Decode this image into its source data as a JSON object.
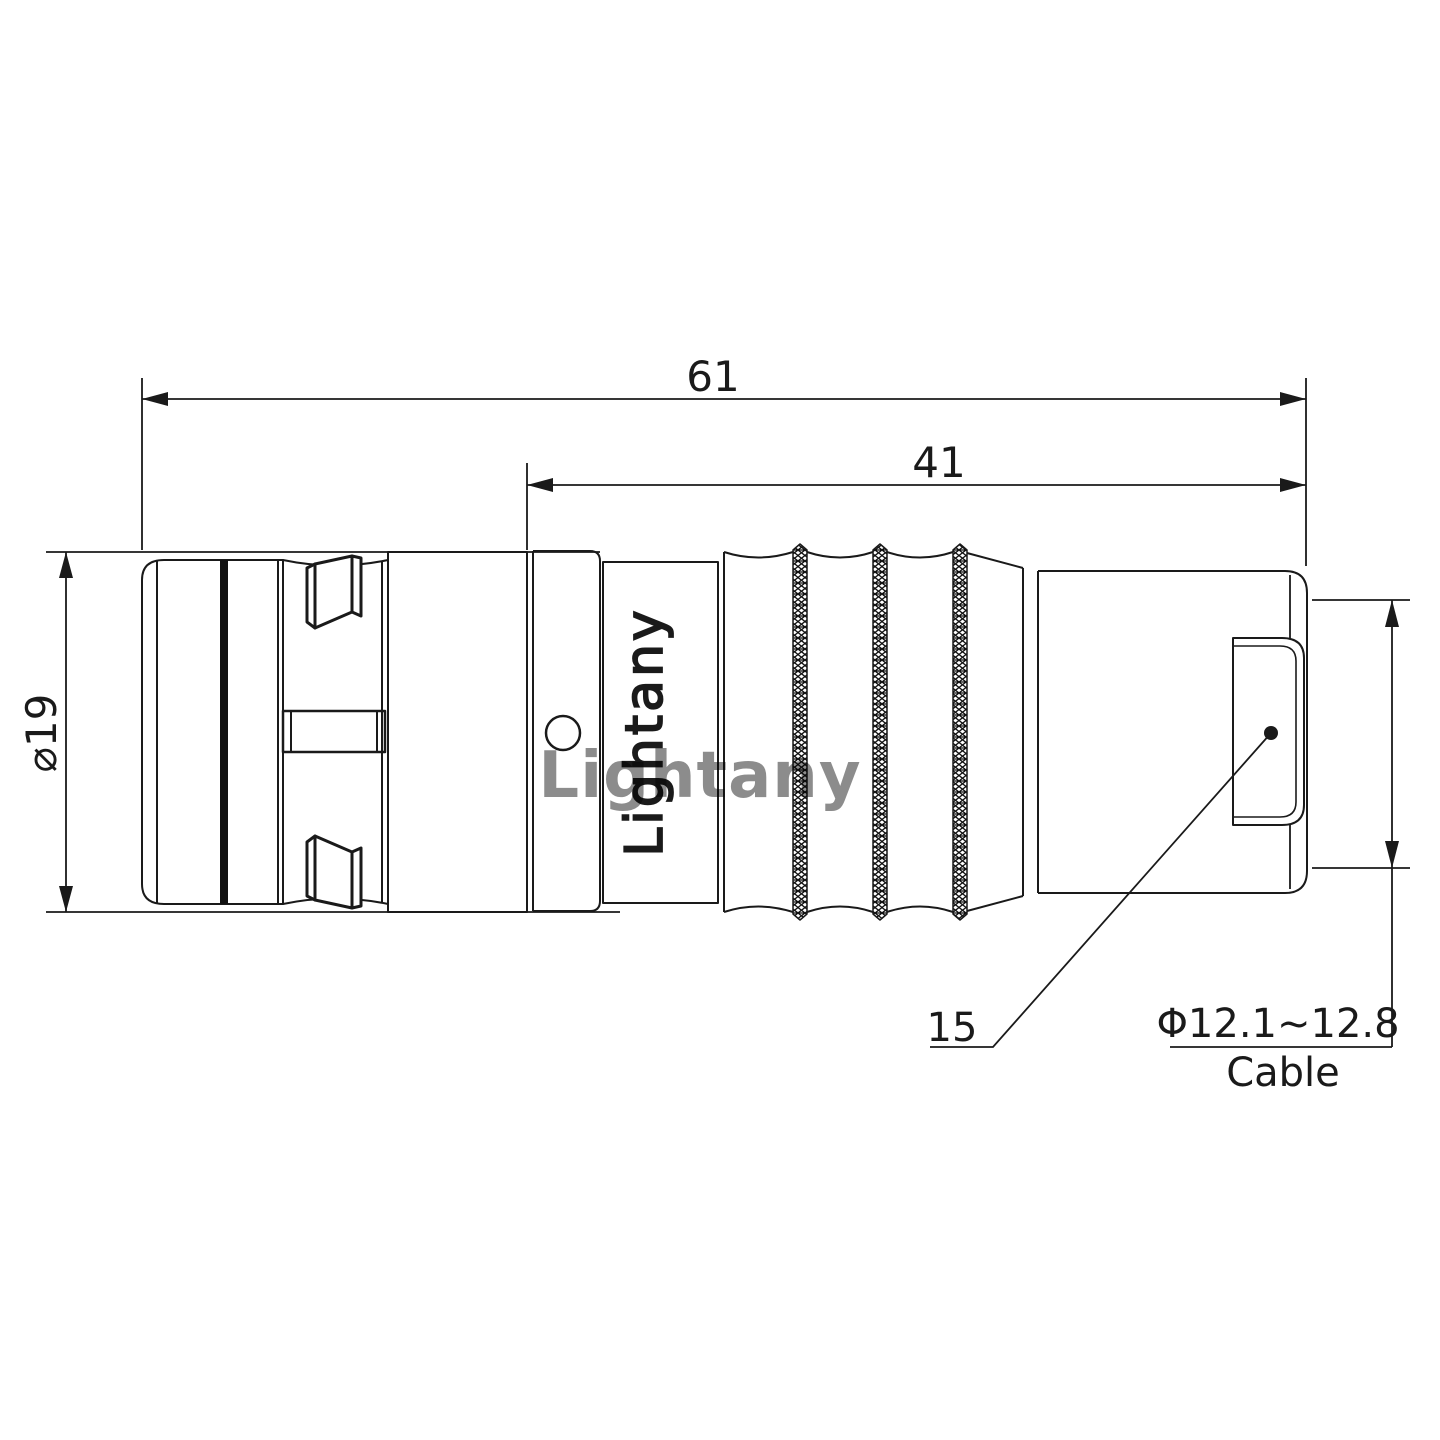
{
  "drawing": {
    "title": "connector-side-view-technical-drawing",
    "units": "mm",
    "dim_overall": "61",
    "dim_rear": "41",
    "dim_diameter": "⌀19",
    "part_ref": "15",
    "cable_dia": "Φ12.1~12.8",
    "cable_label": "Cable",
    "engraving": "Lightany",
    "watermark": "Lightany",
    "colors": {
      "line": "#1a1a1a",
      "fill": "#ffffff",
      "watermark_pink": "#e08f8f"
    }
  }
}
